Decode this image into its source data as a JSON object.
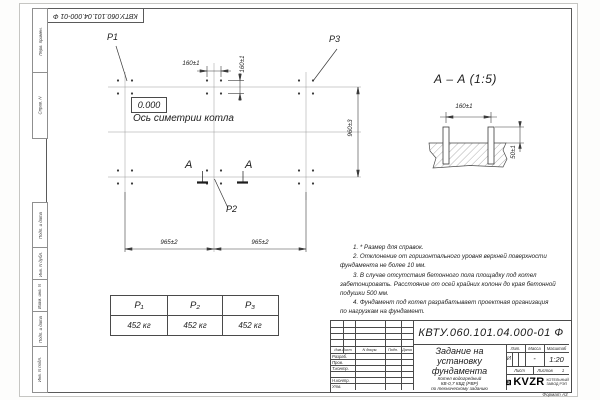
{
  "doc": {
    "number": "КВТУ.060.101.04.000-01 Ф",
    "format": "Формат А3"
  },
  "margin": {
    "fields": [
      "Перв. примен.",
      "Справ. N",
      "Подп. и дата",
      "Инв. N дубл.",
      "Взам. инв. N",
      "Подп. и дата",
      "Инв. N подл."
    ]
  },
  "plan": {
    "labels": {
      "p1": "P1",
      "p2": "P2",
      "p3": "P3",
      "elevation": "0.000",
      "axis": "Ось симетрии котла",
      "section_a": "А"
    },
    "dims": {
      "top_h": "160±1",
      "top_v": "160±1",
      "right_v": "960±3",
      "bottom_left": "965±2",
      "bottom_right": "965±2"
    }
  },
  "section": {
    "title": "А – А (1:5)",
    "dim_width": "160±1",
    "dim_height": "50±1"
  },
  "notes": {
    "lines": [
      "1. * Размер для справок.",
      "2. Отклонение от горизонтального уровня верхней поверхности",
      "фундамента не более 10 мм.",
      "3. В случае отсутствия бетонного пола площадку под котел",
      "забетонировать. Расстояние от осей крайних колонн до края бетонной",
      "подушки 500 мм.",
      "4. Фундамент под котел разрабатывает проектная организация",
      "по нагрузкам на фундамент."
    ]
  },
  "load_table": {
    "headers": [
      "P₁",
      "P₂",
      "P₃"
    ],
    "values": [
      "452 кг",
      "452 кг",
      "452 кг"
    ]
  },
  "title_block": {
    "title_lines": [
      "Задание на",
      "установку",
      "фундамента"
    ],
    "subtitle_lines": [
      "Котел водогрейный",
      "КВ-0,7 КБД (РВР)",
      "по техническому заданию"
    ],
    "columns": [
      "Изм.Лист",
      "N докум.",
      "Подп.",
      "Дата"
    ],
    "rows": [
      "Разраб.",
      "Пров.",
      "Т.контр.",
      "Н.контр.",
      "Утв."
    ],
    "lit": {
      "label": "Лит.",
      "value": "И"
    },
    "mass": {
      "label": "Масса",
      "value": "-"
    },
    "scale": {
      "label": "Масштаб",
      "value": "1:20"
    },
    "sheet": {
      "label": "Лист"
    },
    "sheets": {
      "label": "Листов",
      "value": "1"
    },
    "logo": {
      "text": "KVZR",
      "sub": [
        "КОТЕЛЬНЫЙ",
        "ЗАВОД РЭП"
      ]
    }
  }
}
